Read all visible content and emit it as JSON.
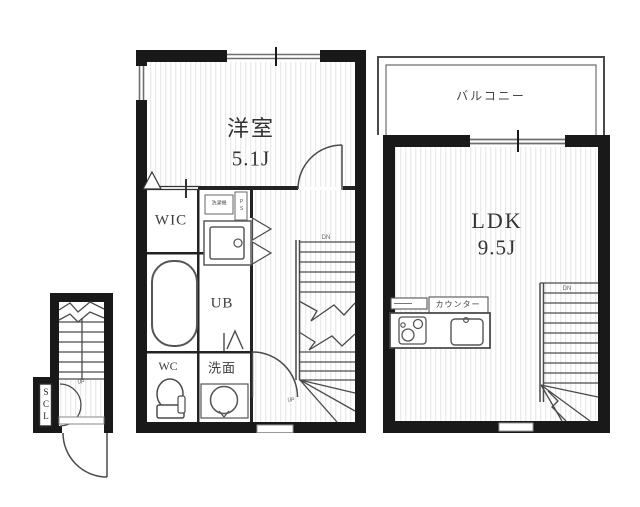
{
  "floor1": {
    "room_label": "洋室",
    "room_size": "5.1J",
    "wic": "WIC",
    "ub": "UB",
    "wc": "WC",
    "senmen": "洗面",
    "washer": "洗濯機",
    "ps": "PS",
    "stairs_dn": "DN",
    "stairs_up": "UP"
  },
  "floor2": {
    "balcony": "バルコニー",
    "room_label": "LDK",
    "room_size": "9.5J",
    "counter": "カウンター",
    "stairs_dn": "DN"
  },
  "entrance": {
    "scl": "SCL",
    "stairs_up": "UP"
  },
  "colors": {
    "wall": "#191919",
    "line": "#4a4a4a",
    "stripe": "#e8e8e8"
  }
}
